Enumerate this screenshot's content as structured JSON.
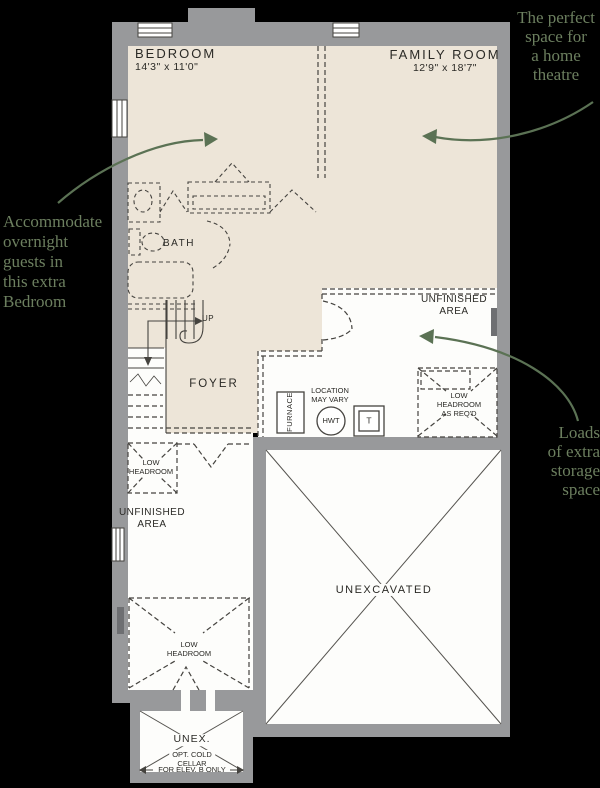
{
  "colors": {
    "background": "#000000",
    "finished_area_fill": "#EDE5D8",
    "wall_gray": "#98999B",
    "plan_line": "#45433F",
    "label_text": "#2B2A26",
    "annotation_green": "#6C7F5F",
    "arrow_green": "#5B7254",
    "unfinished_fill": "#FDFDFB"
  },
  "plan": {
    "bedroom": {
      "name": "BEDROOM",
      "dims": "14'3\" x 11'0\""
    },
    "family_room": {
      "name": "FAMILY ROOM",
      "dims": "12'9\" x 18'7\""
    },
    "bath": "BATH",
    "up": "UP",
    "foyer": "FOYER",
    "furnace": "FURNACE",
    "hwt": "HWT",
    "tank": "T",
    "location_note": [
      "LOCATION",
      "MAY VARY"
    ],
    "unfinished_right": [
      "UNFINISHED",
      "AREA"
    ],
    "low_headroom_right": [
      "LOW",
      "HEADROOM",
      "AS REQ'D"
    ],
    "low_headroom_left": [
      "LOW",
      "HEADROOM"
    ],
    "unfinished_left": [
      "UNFINISHED",
      "AREA"
    ],
    "low_headroom_bottom": [
      "LOW",
      "HEADROOM"
    ],
    "unexcavated": "UNEXCAVATED",
    "unex": "UNEX.",
    "cold_cellar": [
      "OPT. COLD",
      "CELLAR"
    ],
    "elev_note": "FOR ELEV. B ONLY"
  },
  "annotations": {
    "theatre": [
      "The perfect",
      "space for",
      "a home",
      "theatre"
    ],
    "guests": [
      "Accommodate",
      "overnight",
      "guests in",
      "this extra",
      "Bedroom"
    ],
    "storage": [
      "Loads",
      "of extra",
      "storage",
      "space"
    ]
  }
}
